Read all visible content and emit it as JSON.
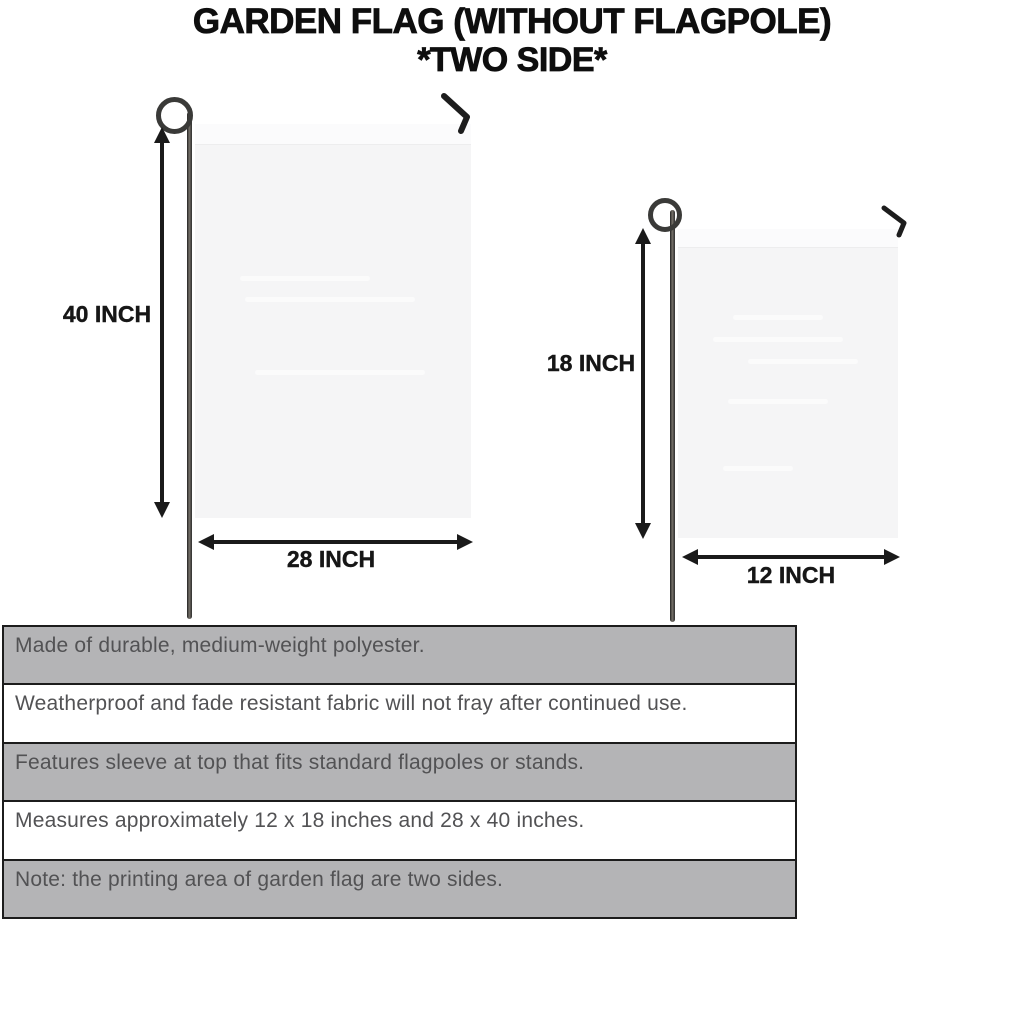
{
  "title": {
    "line1": "GARDEN FLAG (WITHOUT FLAGPOLE)",
    "line2": "*TWO SIDE*"
  },
  "diagrams": {
    "large_flag": {
      "height_label": "40 INCH",
      "width_label": "28 INCH"
    },
    "small_flag": {
      "height_label": "18 INCH",
      "width_label": "12 INCH"
    }
  },
  "features": {
    "rows": [
      {
        "text": "Made of durable, medium-weight polyester.",
        "shaded": true
      },
      {
        "text": "Weatherproof and fade resistant fabric will not fray after continued use.",
        "shaded": false
      },
      {
        "text": "Features sleeve at top that fits standard flagpoles or stands.",
        "shaded": true
      },
      {
        "text": "Measures approximately 12 x 18 inches and 28 x 40 inches.",
        "shaded": false
      },
      {
        "text": "Note: the printing area of garden flag are two sides.",
        "shaded": true
      }
    ]
  },
  "colors": {
    "title_text": "#0e0e0e",
    "dimension_text": "#161616",
    "arrow": "#1a1a1a",
    "table_border": "#1c1c1c",
    "table_row_shaded": "#b4b4b6",
    "table_row_plain": "#ffffff",
    "table_text": "#525254",
    "flag_fill": "#f5f5f6",
    "flag_sleeve": "#fbfbfc",
    "pole": "#2e2e2e"
  }
}
